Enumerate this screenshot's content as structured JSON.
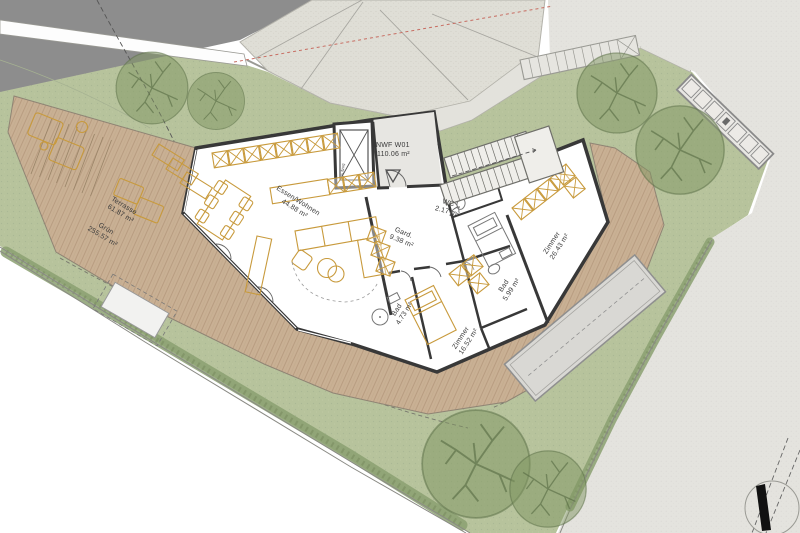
{
  "plan": {
    "unit_label": {
      "name": "NWF W01",
      "area": "110.06 m²"
    },
    "rooms": [
      {
        "name": "Essen/Wohnen",
        "area": "44.88 m²"
      },
      {
        "name": "Gard.",
        "area": "9.38 m²"
      },
      {
        "name": "WC",
        "area": "2.17 m²"
      },
      {
        "name": "Zimmer",
        "area": "26.43 m²"
      },
      {
        "name": "Bad",
        "area": "5.99 m²"
      },
      {
        "name": "Zimmer",
        "area": "16.52 m²"
      },
      {
        "name": "Bad",
        "area": "4.73 m²"
      }
    ],
    "outdoor_areas": [
      {
        "name": "Terrasse",
        "area": "61.87 m²"
      },
      {
        "name": "Grün",
        "area": "255.57 m²"
      }
    ],
    "elevator_label": "Aufzug",
    "colors": {
      "lawn": "#b7c39c",
      "hedge": "#8ba071",
      "deck_wood": "#c9b094",
      "furniture_accent": "#c89a3c",
      "walls": "#383838",
      "pavement": "#e4e3de",
      "gravel": "#dfded6",
      "road": "#8d8d8d",
      "pool": "#d9d8d4",
      "red_survey_line": "#c76d62"
    }
  }
}
